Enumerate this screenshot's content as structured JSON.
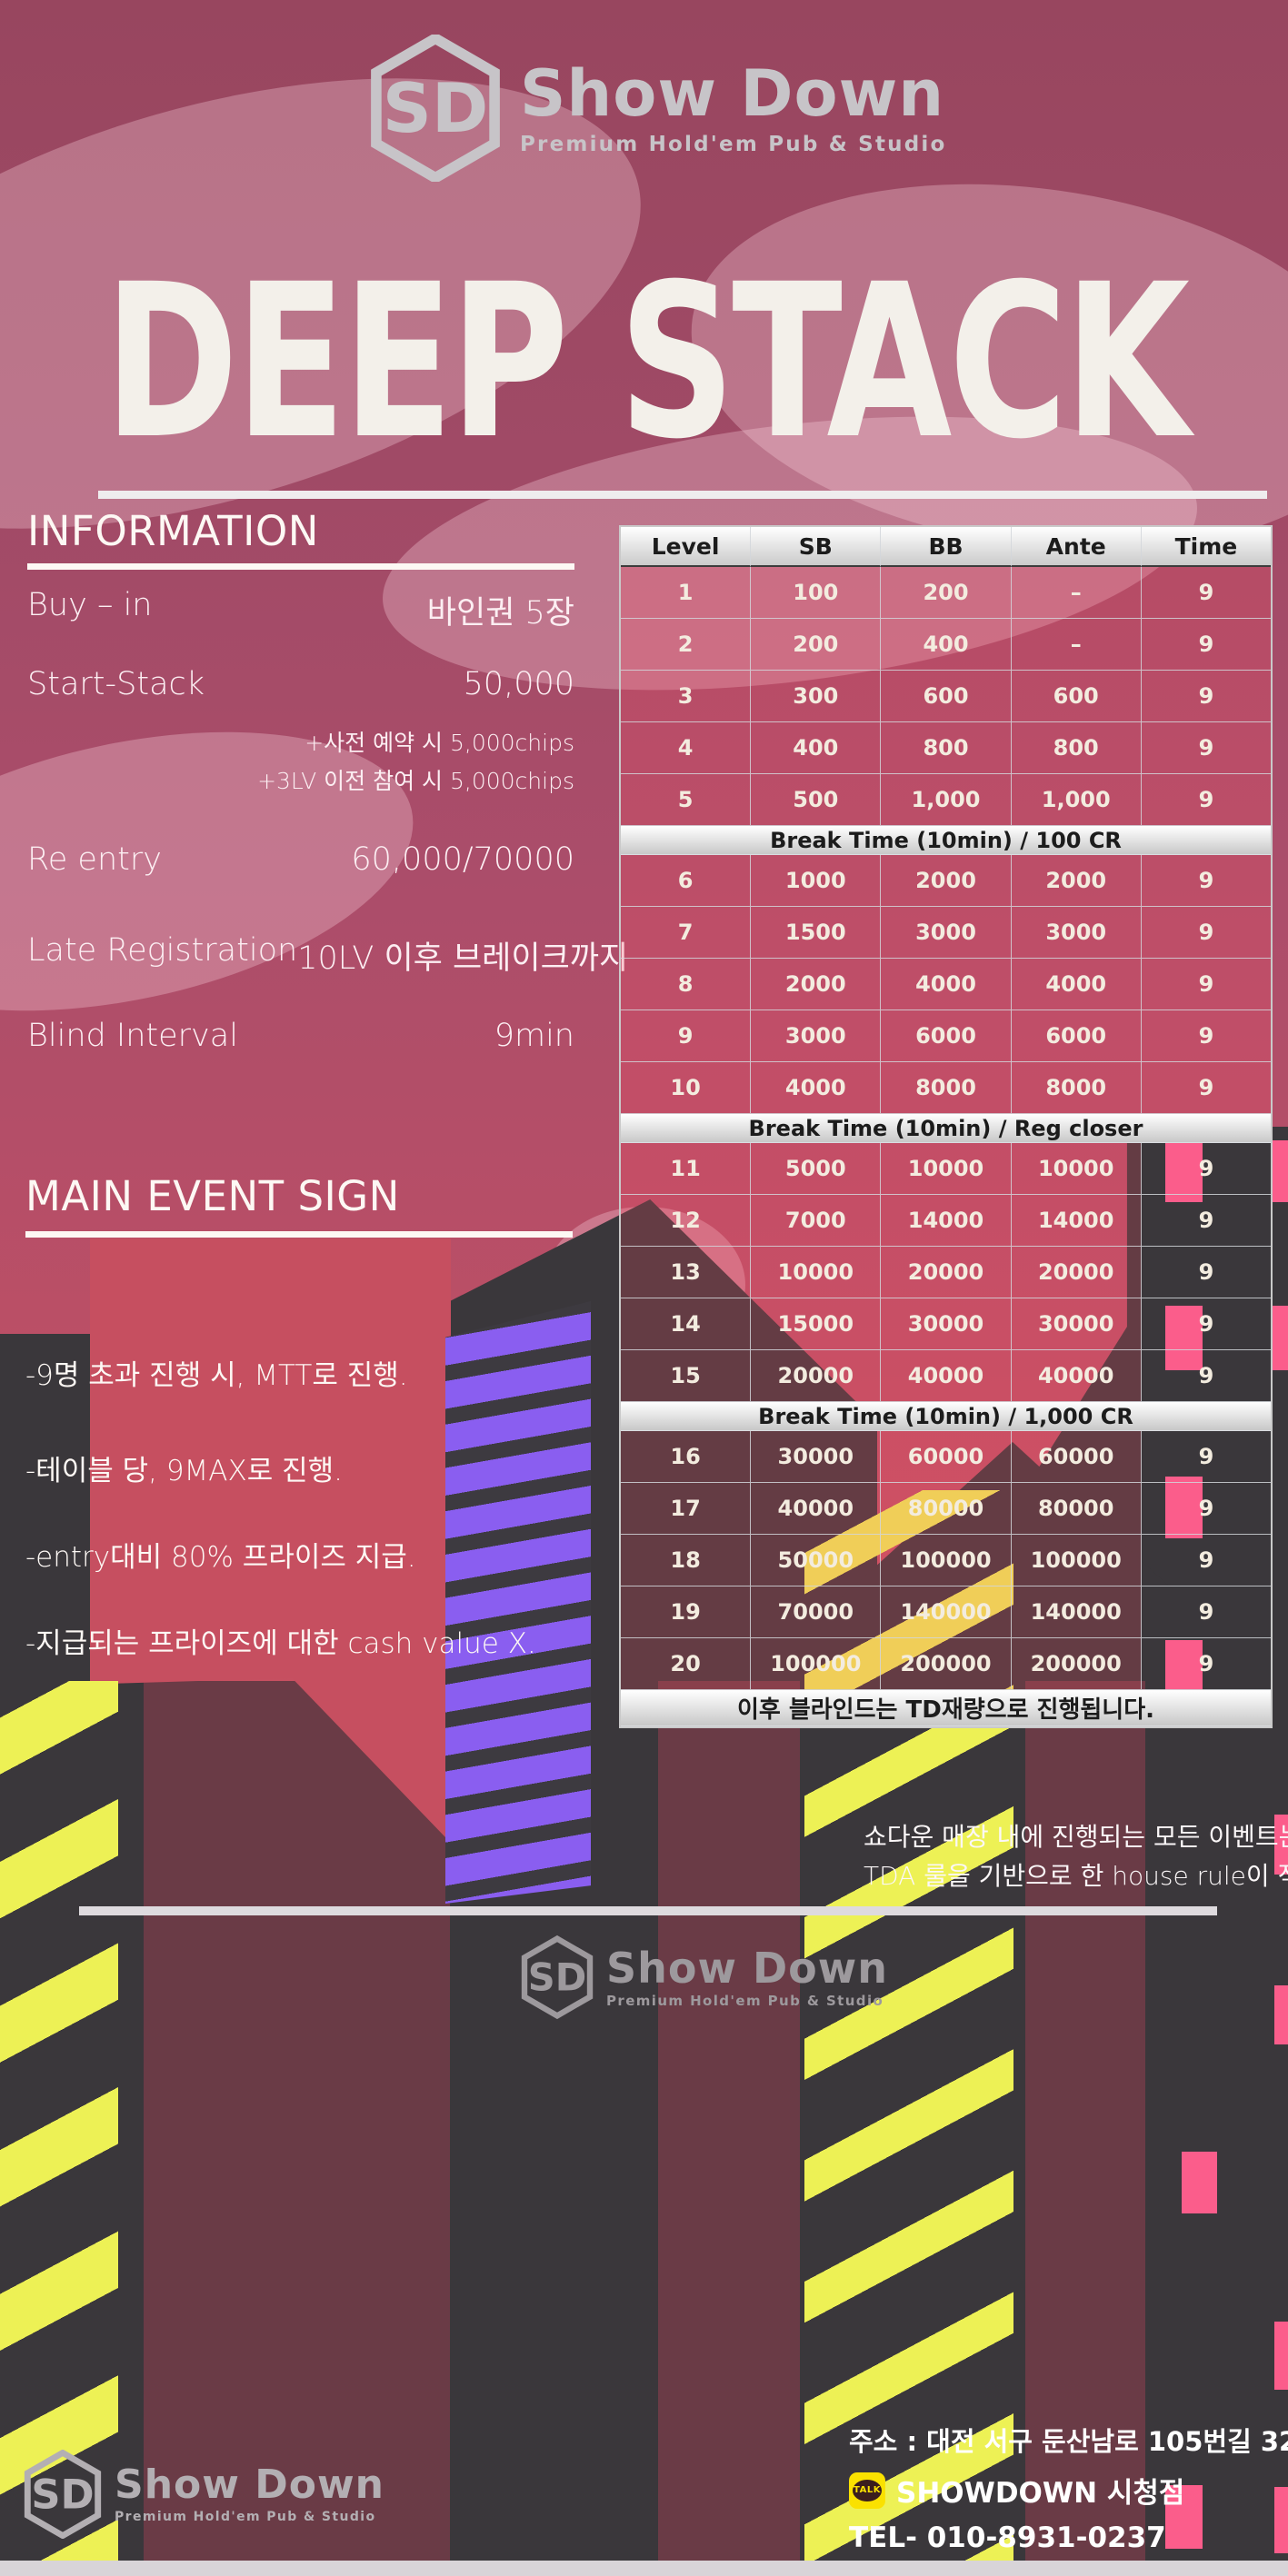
{
  "brand": {
    "monogram": "SD",
    "name": "Show Down",
    "tagline": "Premium Hold'em Pub & Studio"
  },
  "title": "DEEP STACK",
  "information": {
    "heading": "INFORMATION",
    "rows": [
      {
        "label": "Buy – in",
        "value": "바인권 5장"
      },
      {
        "label": "Start-Stack",
        "value": "50,000",
        "notes": [
          "+사전 예약 시 5,000chips",
          "+3LV 이전 참여 시 5,000chips"
        ]
      },
      {
        "label": "Re entry",
        "value": "60,000/70000"
      },
      {
        "label": "Late Registration",
        "value": "10LV 이후 브레이크까지"
      },
      {
        "label": "Blind Interval",
        "value": "9min"
      }
    ]
  },
  "main_event": {
    "heading": "MAIN EVENT SIGN",
    "bullets": [
      "-9명 초과 진행 시, MTT로 진행.",
      "-테이블 당, 9MAX로 진행.",
      "-entry대비 80% 프라이즈 지급.",
      "-지급되는 프라이즈에 대한 cash value X."
    ]
  },
  "blind_table": {
    "columns": [
      "Level",
      "SB",
      "BB",
      "Ante",
      "Time"
    ],
    "sections": [
      {
        "rows": [
          [
            "1",
            "100",
            "200",
            "–",
            "9"
          ],
          [
            "2",
            "200",
            "400",
            "–",
            "9"
          ],
          [
            "3",
            "300",
            "600",
            "600",
            "9"
          ],
          [
            "4",
            "400",
            "800",
            "800",
            "9"
          ],
          [
            "5",
            "500",
            "1,000",
            "1,000",
            "9"
          ]
        ]
      },
      {
        "break_label": "Break Time (10min) / 100 CR",
        "rows": [
          [
            "6",
            "1000",
            "2000",
            "2000",
            "9"
          ],
          [
            "7",
            "1500",
            "3000",
            "3000",
            "9"
          ],
          [
            "8",
            "2000",
            "4000",
            "4000",
            "9"
          ],
          [
            "9",
            "3000",
            "6000",
            "6000",
            "9"
          ],
          [
            "10",
            "4000",
            "8000",
            "8000",
            "9"
          ]
        ]
      },
      {
        "break_label": "Break Time (10min) / Reg closer",
        "rows": [
          [
            "11",
            "5000",
            "10000",
            "10000",
            "9"
          ],
          [
            "12",
            "7000",
            "14000",
            "14000",
            "9"
          ],
          [
            "13",
            "10000",
            "20000",
            "20000",
            "9"
          ],
          [
            "14",
            "15000",
            "30000",
            "30000",
            "9"
          ],
          [
            "15",
            "20000",
            "40000",
            "40000",
            "9"
          ]
        ]
      },
      {
        "break_label": "Break Time (10min) / 1,000 CR",
        "rows": [
          [
            "16",
            "30000",
            "60000",
            "60000",
            "9"
          ],
          [
            "17",
            "40000",
            "80000",
            "80000",
            "9"
          ],
          [
            "18",
            "50000",
            "100000",
            "100000",
            "9"
          ],
          [
            "19",
            "70000",
            "140000",
            "140000",
            "9"
          ],
          [
            "20",
            "100000",
            "200000",
            "200000",
            "9"
          ]
        ]
      }
    ],
    "footer_note": "이후 블라인드는 TD재량으로 진행됩니다."
  },
  "notice": {
    "line1": "쇼다운 매장 내에 진행되는 모든 이벤트는",
    "line2": "TDA 룰을 기반으로 한 house rule이 적용됩니다."
  },
  "contact": {
    "address": "주소 : 대전 서구 둔산남로 105번길 32, 2층",
    "kakao_icon_label": "TALK",
    "kakao_name": "SHOWDOWN 시청점",
    "tel": "TEL- 010-8931-0237"
  },
  "colors": {
    "rose_top": "#9a4862",
    "rose_bottom": "#c84f60",
    "charcoal": "#3a373b",
    "maroon_building": "#6a3b46",
    "flag_red": "#c64f60",
    "neon_purple": "#8a5ef0",
    "neon_yellow": "#edf155",
    "neon_pink_window": "#fb5d8b",
    "table_band": "#ffffff",
    "kakao_yellow": "#fae100"
  }
}
